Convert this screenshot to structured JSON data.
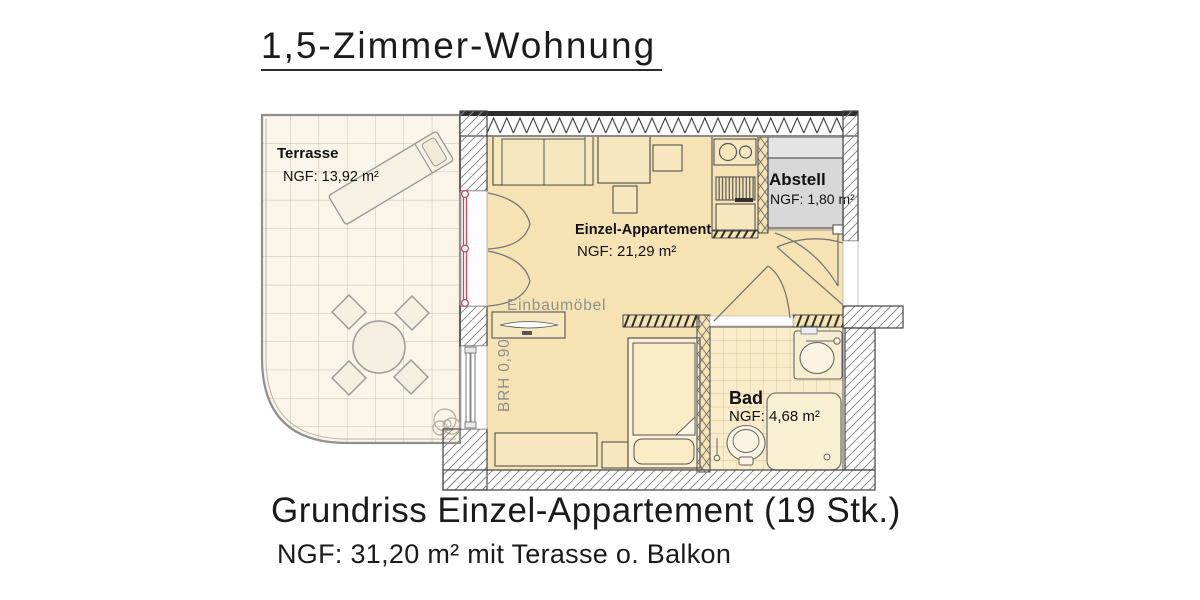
{
  "title": "1,5-Zimmer-Wohnung",
  "caption": {
    "heading": "Grundriss Einzel-Appartement (19 Stk.)",
    "subheading": "NGF: 31,20 m² mit Terasse o. Balkon"
  },
  "rooms": {
    "terrasse": {
      "name": "Terrasse",
      "area": "NGF: 13,92 m²"
    },
    "apartment": {
      "name": "Einzel-Appartement",
      "area": "NGF: 21,29 m²"
    },
    "abstell": {
      "name": "Abstell",
      "area": "NGF: 1,80 m²"
    },
    "bad": {
      "name": "Bad",
      "area": "NGF: 4,68 m²"
    }
  },
  "annotations": {
    "built_in_furniture": "Einbaumöbel",
    "window_sill_height": "BRH 0,90"
  },
  "colors": {
    "apartment_floor": "#f6e3b3",
    "furniture_fill": "#f7e7bf",
    "terrace_floor": "#faf4e9",
    "storage_floor": "#d8d8d8",
    "bath_tiles": "#f8ecca",
    "glazing_red": "#c5485c",
    "wall_line": "#444444",
    "label_gray": "#8f8f8f"
  }
}
